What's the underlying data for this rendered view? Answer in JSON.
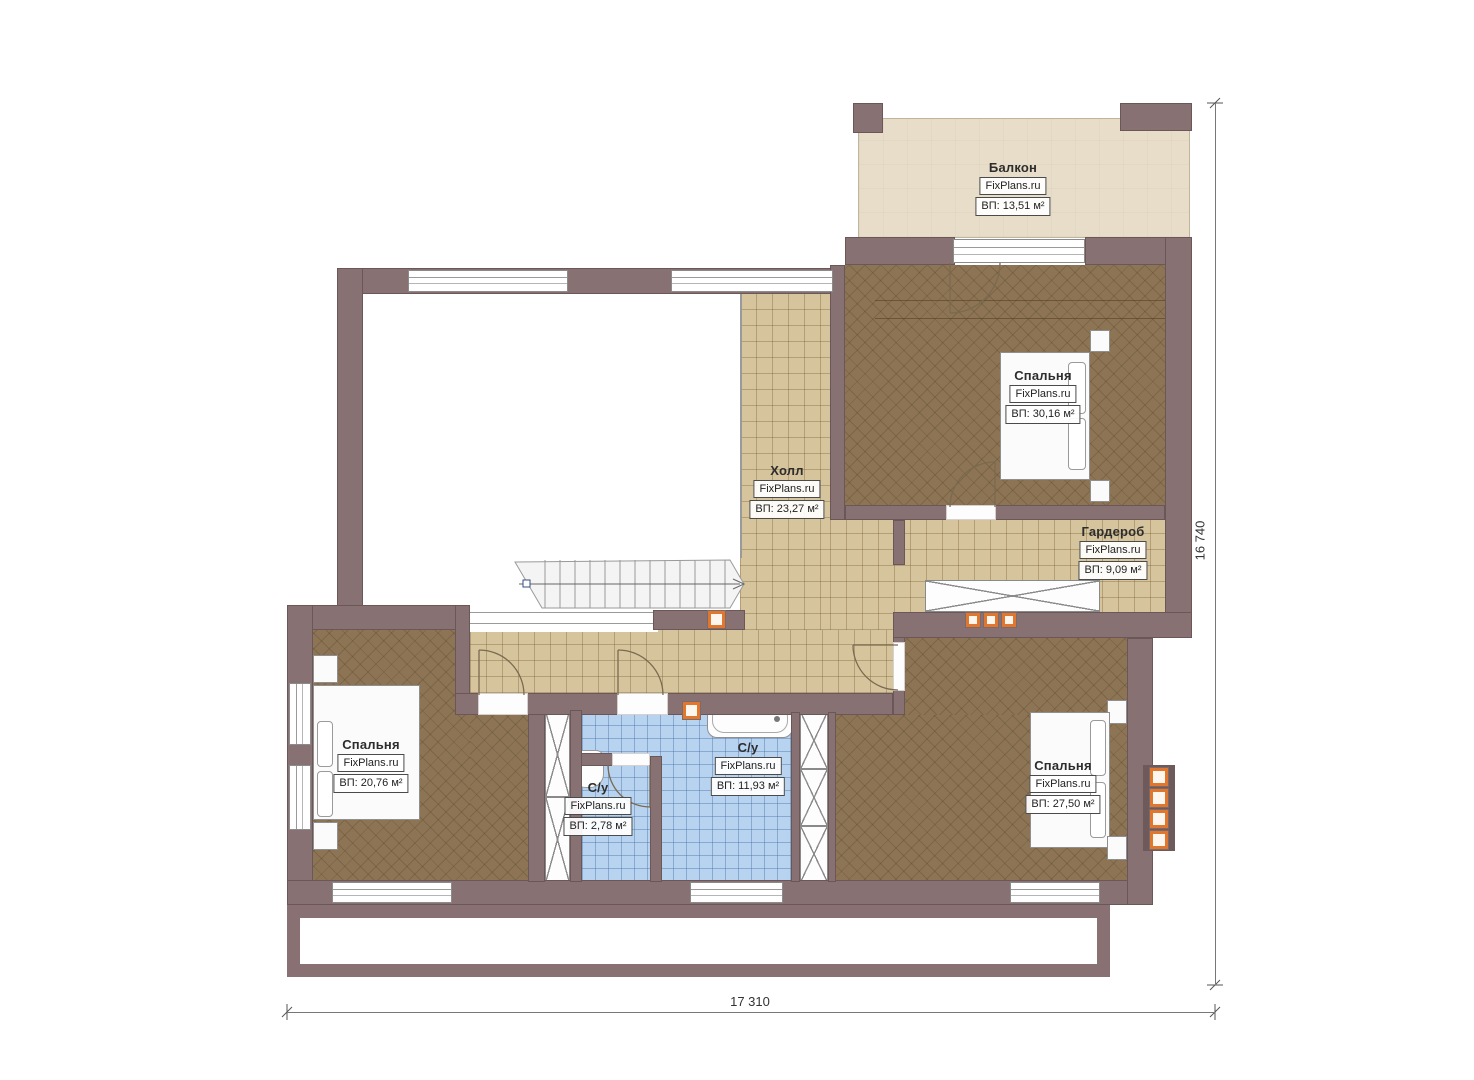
{
  "brand": "FixPlans.ru",
  "rooms": {
    "balcony": {
      "name": "Балкон",
      "area": "ВП: 13,51 м²"
    },
    "bedroom_top": {
      "name": "Спальня",
      "area": "ВП: 30,16 м²"
    },
    "hall": {
      "name": "Холл",
      "area": "ВП: 23,27 м²"
    },
    "wardrobe": {
      "name": "Гардероб",
      "area": "ВП: 9,09 м²"
    },
    "bedroom_left": {
      "name": "Спальня",
      "area": "ВП: 20,76 м²"
    },
    "bath_main": {
      "name": "С/у",
      "area": "ВП: 11,93 м²"
    },
    "bath_small": {
      "name": "С/у",
      "area": "ВП: 2,78 м²"
    },
    "bedroom_right": {
      "name": "Спальня",
      "area": "ВП: 27,50 м²"
    }
  },
  "dimensions": {
    "width": "17 310",
    "height": "16 740"
  },
  "colors": {
    "wall": "#877172",
    "tile_floor": "#d6c49c",
    "wood_floor": "#8c7454",
    "bath_floor": "#b7d3ef",
    "balcony_floor": "#e7ddc8",
    "accent_orange": "#e1762f"
  }
}
